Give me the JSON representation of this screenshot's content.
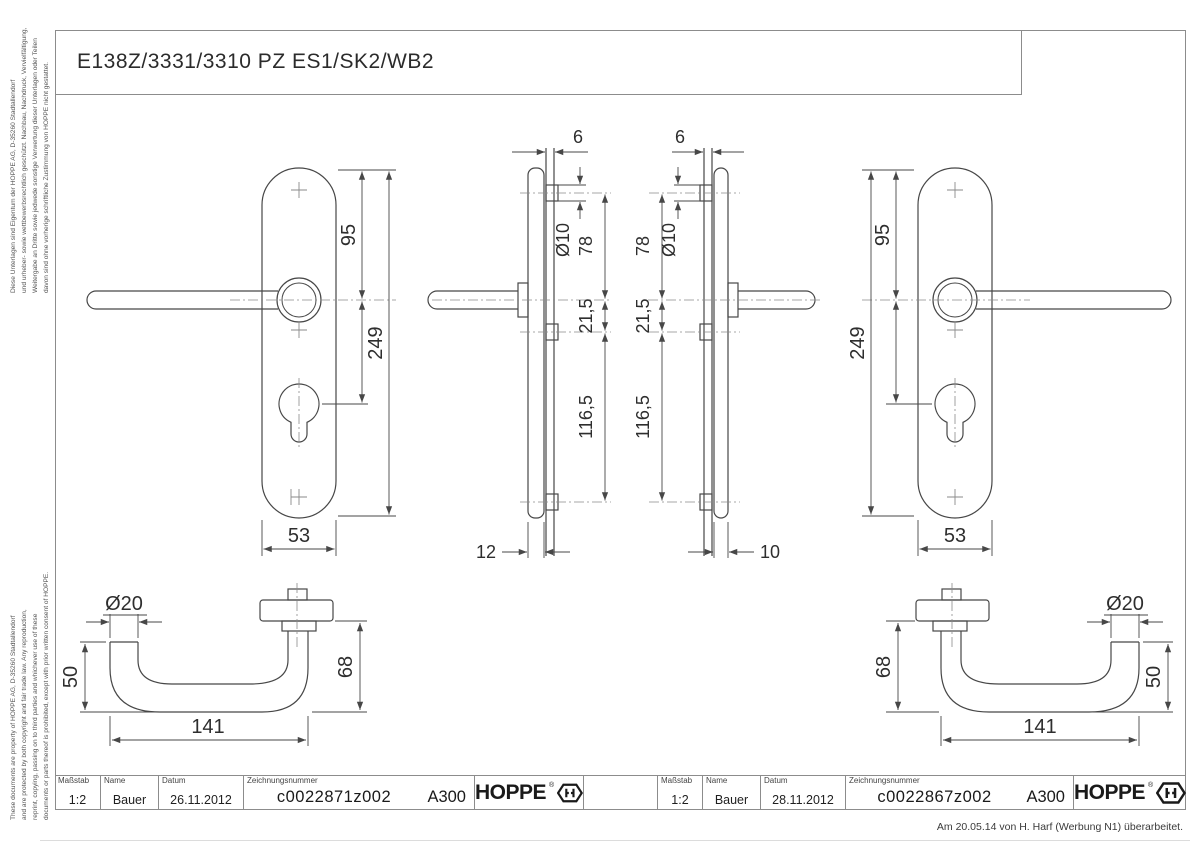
{
  "sheet": {
    "title": "E138Z/3331/3310 PZ ES1/SK2/WB2",
    "revision_note": "Am 20.05.14 von H. Harf (Werbung N1) überarbeitet.",
    "brand": "HOPPE",
    "brand_mark": "®"
  },
  "disclaimer_de": [
    "Diese Unterlagen sind Eigentum der HOPPE AG, D-35260 Stadtallendorf",
    "und urheber- sowie wettbewerbsrechtlich geschützt. Nachbau, Nachdruck, Vervielfältigung,",
    "Weitergabe an Dritte sowie jedwede sonstige Verwertung dieser Unterlagen oder Teilen",
    "davon sind ohne vorherige schriftliche Zustimmung von HOPPE nicht gestattet."
  ],
  "disclaimer_en": [
    "These documents are property of HOPPE AG, D-35260 Stadtallendorf",
    "and are protected by both copyright and fair trade law. Any reproduction,",
    "reprint, copying, passing on to third parties and whichever use of these",
    "documents or parts thereof is prohibited, except with prior written consent of HOPPE."
  ],
  "title_blocks": {
    "left": {
      "scale_label": "Maßstab",
      "scale": "1:2",
      "name_label": "Name",
      "name": "Bauer",
      "date_label": "Datum",
      "date": "26.11.2012",
      "number_label": "Zeichnungsnummer",
      "number": "c0022871z002",
      "code": "A300"
    },
    "right": {
      "scale_label": "Maßstab",
      "scale": "1:2",
      "name_label": "Name",
      "name": "Bauer",
      "date_label": "Datum",
      "date": "28.11.2012",
      "number_label": "Zeichnungsnummer",
      "number": "c0022867z002",
      "code": "A300"
    }
  },
  "dims": {
    "plate_left": {
      "top_to_handle": "95",
      "total_height": "249",
      "width": "53"
    },
    "plate_right": {
      "top_to_handle": "95",
      "total_height": "249",
      "width": "53"
    },
    "side_left": {
      "gauge": "6",
      "pin_dia": "Ø10",
      "pin_to_handle": "78",
      "handle_to_mid": "21,5",
      "mid_to_bottom": "116,5",
      "depth": "12"
    },
    "side_right": {
      "gauge": "6",
      "pin_dia": "Ø10",
      "pin_to_handle": "78",
      "handle_to_mid": "21,5",
      "mid_to_bottom": "116,5",
      "depth": "10"
    },
    "handle_left": {
      "grip_dia": "Ø20",
      "end_height": "50",
      "length": "141",
      "neck_height": "68"
    },
    "handle_right": {
      "grip_dia": "Ø20",
      "end_height": "50",
      "length": "141",
      "neck_height": "68"
    }
  }
}
